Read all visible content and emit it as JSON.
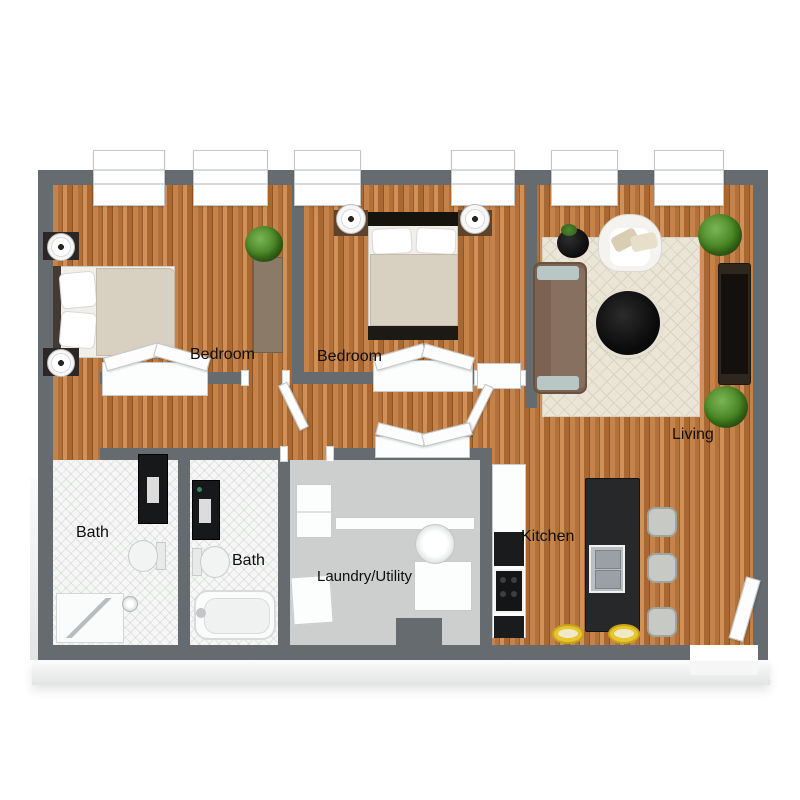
{
  "plan_type": "apartment-3d-floor-plan",
  "rooms": [
    {
      "id": "bedroom-1",
      "label": "Bedroom"
    },
    {
      "id": "bedroom-2",
      "label": "Bedroom"
    },
    {
      "id": "living",
      "label": "Living"
    },
    {
      "id": "bath-1",
      "label": "Bath"
    },
    {
      "id": "bath-2",
      "label": "Bath"
    },
    {
      "id": "laundry",
      "label": "Laundry/Utility"
    },
    {
      "id": "kitchen",
      "label": "Kitchen"
    }
  ],
  "colors": {
    "wall": "#666b6f",
    "wood_light": "#c5834a",
    "wood_dark": "#9c5d2a",
    "bath_tile": "#f5f6f5",
    "laundry_floor": "#cdcfcf",
    "rug": "#eae5d6",
    "sofa_brown": "#7c6252",
    "island_black": "#26282a",
    "stool_yellow": "#e8c530",
    "plant_green": "#44821f",
    "bed_linen": "#d8d1c2"
  }
}
